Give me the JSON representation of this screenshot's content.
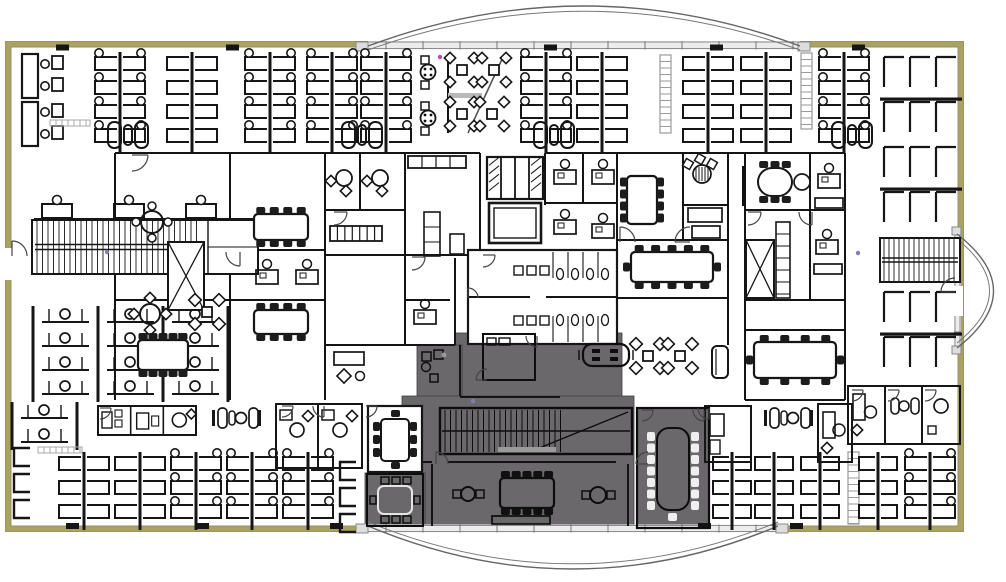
{
  "title": "Office floor plan with highlighted core zone",
  "canvas": {
    "w": 1006,
    "h": 582
  },
  "palette": {
    "floor": "#ffffff",
    "line": "#161616",
    "line_light": "#9a9a9a",
    "wall_outer": "#a9a35f",
    "wall_edge": "#6f6a40",
    "wall_inner": "#7a7446",
    "glass_fill": "#ececec",
    "glass_line": "#8d8d8d",
    "highlight": "#6b686c",
    "highlight_edge": "#403e41",
    "chair_dark": "#1c1c1c",
    "chair_light": "#efefef",
    "artifact_magenta": "#b84ab8",
    "artifact_blue": "#8080b0"
  },
  "building": {
    "x": 8,
    "y": 44,
    "w": 953,
    "h": 485
  },
  "glass": {
    "top": {
      "x": 368,
      "y": 41,
      "w": 432,
      "h": 8.5
    },
    "bottom": {
      "x": 368,
      "y": 524.5,
      "w": 410,
      "h": 8
    },
    "right": {
      "x": 954,
      "y": 234,
      "w": 7,
      "h": 114
    }
  },
  "arcs": {
    "top": {
      "x1": 368,
      "y1": 46,
      "cx": 584,
      "cy": -34,
      "x2": 800,
      "y2": 46,
      "off": 4
    },
    "bottom": {
      "x1": 368,
      "y1": 526,
      "cx": 573,
      "cy": 612,
      "x2": 778,
      "y2": 526,
      "off": -4
    },
    "right": {
      "x1": 957,
      "y1": 234,
      "cx": 1030,
      "cy": 291,
      "x2": 957,
      "y2": 348,
      "off": -5
    }
  },
  "highlights": [
    {
      "x": 455,
      "y": 333,
      "w": 167,
      "h": 65
    },
    {
      "x": 417,
      "y": 345,
      "w": 45,
      "h": 62
    },
    {
      "x": 402,
      "y": 396,
      "w": 232,
      "h": 132
    },
    {
      "x": 365,
      "y": 473,
      "w": 60,
      "h": 55
    },
    {
      "x": 637,
      "y": 408,
      "w": 72,
      "h": 120
    }
  ],
  "walls": [
    [
      115,
      153,
      115,
      400
    ],
    [
      230,
      153,
      230,
      400
    ],
    [
      325,
      153,
      325,
      400
    ],
    [
      405,
      153,
      405,
      345
    ],
    [
      480,
      153,
      480,
      255
    ],
    [
      545,
      153,
      545,
      205
    ],
    [
      583,
      153,
      583,
      203
    ],
    [
      617,
      153,
      617,
      345
    ],
    [
      683,
      153,
      683,
      240
    ],
    [
      728,
      153,
      728,
      345
    ],
    [
      745,
      153,
      745,
      400
    ],
    [
      810,
      153,
      810,
      300
    ],
    [
      845,
      153,
      845,
      400
    ],
    [
      448,
      57,
      448,
      133
    ],
    [
      455,
      258,
      455,
      345
    ],
    [
      460,
      345,
      460,
      396
    ],
    [
      432,
      464,
      432,
      526
    ],
    [
      628,
      464,
      628,
      526
    ],
    [
      360,
      153,
      360,
      210
    ],
    [
      115,
      153,
      480,
      153
    ],
    [
      545,
      153,
      845,
      153
    ],
    [
      115,
      250,
      325,
      250
    ],
    [
      405,
      255,
      480,
      255
    ],
    [
      545,
      203,
      617,
      203
    ],
    [
      683,
      205,
      728,
      205
    ],
    [
      115,
      300,
      325,
      300
    ],
    [
      325,
      210,
      405,
      210
    ],
    [
      325,
      255,
      405,
      255
    ],
    [
      405,
      300,
      450,
      300
    ],
    [
      617,
      240,
      728,
      240
    ],
    [
      617,
      298,
      728,
      298
    ],
    [
      745,
      210,
      845,
      210
    ],
    [
      745,
      300,
      845,
      300
    ],
    [
      745,
      330,
      845,
      330
    ],
    [
      745,
      400,
      845,
      400
    ],
    [
      325,
      345,
      455,
      345
    ],
    [
      402,
      462,
      432,
      462
    ],
    [
      448,
      462,
      616,
      462
    ],
    [
      460,
      397,
      560,
      397
    ],
    [
      637,
      408,
      652,
      408
    ],
    [
      692,
      408,
      709,
      408
    ]
  ],
  "diag_walls": [
    [
      503,
      57,
      468,
      133
    ]
  ],
  "door_arcs": [
    [
      132,
      155,
      16,
      0
    ],
    [
      240,
      252,
      14,
      1
    ],
    [
      334,
      212,
      13,
      0
    ],
    [
      412,
      257,
      13,
      0
    ],
    [
      620,
      242,
      15,
      3
    ],
    [
      690,
      242,
      15,
      2
    ],
    [
      748,
      212,
      13,
      0
    ],
    [
      812,
      212,
      13,
      1
    ],
    [
      100,
      408,
      11,
      0
    ],
    [
      282,
      406,
      11,
      0
    ],
    [
      324,
      406,
      11,
      1
    ],
    [
      366,
      406,
      11,
      0
    ],
    [
      436,
      464,
      12,
      3
    ],
    [
      648,
      464,
      12,
      2
    ],
    [
      709,
      408,
      11,
      1
    ],
    [
      852,
      390,
      11,
      0
    ],
    [
      888,
      390,
      11,
      0
    ],
    [
      925,
      390,
      11,
      0
    ],
    [
      642,
      410,
      11,
      0
    ],
    [
      704,
      410,
      11,
      1
    ],
    [
      487,
      380,
      11,
      2
    ],
    [
      537,
      336,
      11,
      1
    ],
    [
      12,
      256,
      15,
      3
    ],
    [
      955,
      292,
      14,
      2
    ],
    [
      483,
      255,
      12,
      0
    ],
    [
      468,
      298,
      10,
      3
    ]
  ],
  "wall_ticks": {
    "top": [
      56,
      226,
      544,
      710,
      852
    ],
    "bottom": [
      66,
      196,
      330,
      698,
      790
    ]
  },
  "wall_gaps": [
    [
      3,
      248,
      10,
      32
    ],
    [
      953,
      286,
      10,
      30
    ]
  ],
  "glass_ends": [
    [
      356,
      42,
      12,
      9
    ],
    [
      798,
      42,
      12,
      9
    ],
    [
      356,
      524,
      12,
      9
    ],
    [
      776,
      524,
      12,
      9
    ],
    [
      952,
      227,
      9,
      8
    ],
    [
      952,
      346,
      9,
      8
    ]
  ],
  "items": [
    {
      "t": "pairdesks",
      "x": 22,
      "y": 54
    },
    {
      "t": "spine",
      "x": 94,
      "y": 52,
      "rows": 4,
      "chairs": true
    },
    {
      "t": "bins",
      "x": 108,
      "y": 122
    },
    {
      "t": "spine",
      "x": 166,
      "y": 52,
      "rows": 4
    },
    {
      "t": "spine",
      "x": 244,
      "y": 52,
      "rows": 4,
      "chairs": true
    },
    {
      "t": "spine",
      "x": 306,
      "y": 52,
      "rows": 4,
      "chairs": true
    },
    {
      "t": "spine",
      "x": 360,
      "y": 52,
      "rows": 4,
      "chairs": true
    },
    {
      "t": "bins",
      "x": 342,
      "y": 122
    },
    {
      "t": "cafe",
      "x": 420,
      "y": 55
    },
    {
      "t": "spine",
      "x": 520,
      "y": 52,
      "rows": 4,
      "chairs": true
    },
    {
      "t": "bins",
      "x": 534,
      "y": 122
    },
    {
      "t": "spine",
      "x": 576,
      "y": 52,
      "rows": 4
    },
    {
      "t": "shelf",
      "x": 660,
      "y": 55,
      "h": 78
    },
    {
      "t": "spine",
      "x": 682,
      "y": 52,
      "rows": 4
    },
    {
      "t": "spine",
      "x": 740,
      "y": 52,
      "rows": 4
    },
    {
      "t": "shelf",
      "x": 801,
      "y": 53,
      "h": 76
    },
    {
      "t": "spine",
      "x": 818,
      "y": 52,
      "rows": 4,
      "chairs": true
    },
    {
      "t": "bins",
      "x": 832,
      "y": 122
    },
    {
      "t": "lgrid",
      "x": 882,
      "y": 55,
      "rows": 4
    },
    {
      "t": "stairR",
      "x": 880,
      "y": 238,
      "w": 80,
      "h": 44
    },
    {
      "t": "lgrid",
      "x": 882,
      "y": 290,
      "rows": 2
    },
    {
      "t": "room",
      "x": 848,
      "y": 386,
      "w": 37,
      "h": 58,
      "f": "desk"
    },
    {
      "t": "room",
      "x": 885,
      "y": 386,
      "w": 37,
      "h": 58,
      "f": "lounge"
    },
    {
      "t": "room",
      "x": 922,
      "y": 386,
      "w": 38,
      "h": 58,
      "f": "circle"
    },
    {
      "t": "ccol",
      "x": 14,
      "y": 448
    },
    {
      "t": "spine",
      "x": 58,
      "y": 452,
      "rows": 3
    },
    {
      "t": "spine",
      "x": 114,
      "y": 452,
      "rows": 3
    },
    {
      "t": "spine",
      "x": 170,
      "y": 452,
      "rows": 3,
      "chairs": true
    },
    {
      "t": "spine",
      "x": 226,
      "y": 452,
      "rows": 3,
      "chairs": true
    },
    {
      "t": "spine",
      "x": 282,
      "y": 452,
      "rows": 3,
      "chairs": true
    },
    {
      "t": "ccol",
      "x": 340,
      "y": 462
    },
    {
      "t": "spine",
      "x": 712,
      "y": 452,
      "rows": 3,
      "w": 40
    },
    {
      "t": "spine",
      "x": 754,
      "y": 452,
      "rows": 3,
      "w": 40
    },
    {
      "t": "spine",
      "x": 800,
      "y": 452,
      "rows": 3,
      "w": 40
    },
    {
      "t": "shelf",
      "x": 848,
      "y": 452,
      "h": 72
    },
    {
      "t": "spine",
      "x": 858,
      "y": 452,
      "rows": 3,
      "w": 40
    },
    {
      "t": "spine",
      "x": 904,
      "y": 452,
      "rows": 3,
      "chairs": true
    },
    {
      "t": "cubegrid",
      "x": 33,
      "y": 306,
      "cols": 3,
      "rows": 2
    },
    {
      "t": "cubegrid",
      "x": 33,
      "y": 354,
      "cols": 3,
      "rows": 2
    },
    {
      "t": "cubegrid",
      "x": 12,
      "y": 402,
      "cols": 1,
      "rows": 2
    },
    {
      "t": "lightstrip",
      "x": 50,
      "y": 120,
      "w": 40
    },
    {
      "t": "lightstrip",
      "x": 38,
      "y": 447,
      "w": 44
    },
    {
      "t": "deskrow",
      "x": 34,
      "y": 196
    },
    {
      "t": "stairL",
      "x": 32,
      "y": 220,
      "w": 226,
      "h": 54
    },
    {
      "t": "roundtable",
      "x": 152,
      "y": 222,
      "r": 11,
      "st": "circle"
    },
    {
      "t": "xcab",
      "x": 168,
      "y": 242,
      "w": 36,
      "h": 68
    },
    {
      "t": "roundtable",
      "x": 150,
      "y": 314,
      "r": 10,
      "st": "diamond"
    },
    {
      "t": "diamondset",
      "x": 207,
      "y": 312
    },
    {
      "t": "conftable",
      "x": 138,
      "y": 340,
      "w": 50,
      "h": 30,
      "top": 5,
      "bot": 5
    },
    {
      "t": "conftable",
      "x": 254,
      "y": 214,
      "w": 54,
      "h": 26,
      "top": 4,
      "bot": 4
    },
    {
      "t": "deskchair",
      "x": 256,
      "y": 270
    },
    {
      "t": "deskchair",
      "x": 296,
      "y": 270
    },
    {
      "t": "conftable",
      "x": 254,
      "y": 310,
      "w": 54,
      "h": 24,
      "top": 4,
      "bot": 4
    },
    {
      "t": "nook",
      "x": 344,
      "y": 178
    },
    {
      "t": "nook",
      "x": 380,
      "y": 178
    },
    {
      "t": "lockers",
      "x": 330,
      "y": 226,
      "w": 52,
      "h": 15,
      "n": 7
    },
    {
      "t": "deskitems",
      "x": 334,
      "y": 352
    },
    {
      "t": "pantry",
      "x": 408,
      "y": 156
    },
    {
      "t": "elevbank",
      "x": 487,
      "y": 157,
      "w": 56,
      "h": 42
    },
    {
      "t": "servelev",
      "x": 489,
      "y": 203,
      "w": 52,
      "h": 40
    },
    {
      "t": "restrooms",
      "x": 468,
      "y": 250,
      "w": 149,
      "h": 94
    },
    {
      "t": "deskchair",
      "x": 554,
      "y": 170
    },
    {
      "t": "deskchair",
      "x": 592,
      "y": 170
    },
    {
      "t": "deskchair",
      "x": 554,
      "y": 220
    },
    {
      "t": "deskchair",
      "x": 592,
      "y": 224
    },
    {
      "t": "deskchair",
      "x": 414,
      "y": 310
    },
    {
      "t": "conftable",
      "x": 627,
      "y": 176,
      "w": 30,
      "h": 48,
      "left": 4,
      "right": 4
    },
    {
      "t": "loungenook",
      "x": 702,
      "y": 174
    },
    {
      "t": "credenza",
      "x": 688,
      "y": 208,
      "w": 34,
      "h": 14
    },
    {
      "t": "credenza",
      "x": 692,
      "y": 226,
      "w": 28,
      "h": 12
    },
    {
      "t": "conftable",
      "x": 631,
      "y": 252,
      "w": 82,
      "h": 30,
      "top": 5,
      "bot": 5,
      "ends": true
    },
    {
      "t": "vbar",
      "x": 742,
      "y": 166,
      "h": 40
    },
    {
      "t": "ovaltable",
      "x": 758,
      "y": 168,
      "w": 34,
      "h": 28
    },
    {
      "t": "deskchair",
      "x": 818,
      "y": 174
    },
    {
      "t": "credenza",
      "x": 815,
      "y": 198,
      "w": 28,
      "h": 10
    },
    {
      "t": "xcab",
      "x": 746,
      "y": 240,
      "w": 28,
      "h": 58
    },
    {
      "t": "cabcol",
      "x": 776,
      "y": 222,
      "w": 14,
      "h": 76
    },
    {
      "t": "deskchair",
      "x": 816,
      "y": 240
    },
    {
      "t": "credenza",
      "x": 814,
      "y": 264,
      "w": 28,
      "h": 10
    },
    {
      "t": "conftable",
      "x": 754,
      "y": 342,
      "w": 82,
      "h": 36,
      "top": 4,
      "bot": 4,
      "ends": true
    },
    {
      "t": "diamondset",
      "x": 648,
      "y": 356
    },
    {
      "t": "diamondset",
      "x": 680,
      "y": 356
    },
    {
      "t": "sofa",
      "x": 712,
      "y": 346,
      "w": 16,
      "h": 32
    },
    {
      "t": "phoneblock",
      "x": 98,
      "y": 406,
      "w": 98,
      "h": 29
    },
    {
      "t": "loungerow",
      "x": 212,
      "y": 410
    },
    {
      "t": "room",
      "x": 276,
      "y": 404,
      "w": 42,
      "h": 64,
      "f": "office"
    },
    {
      "t": "room",
      "x": 318,
      "y": 404,
      "w": 44,
      "h": 64,
      "f": "office"
    },
    {
      "t": "room",
      "x": 705,
      "y": 406,
      "w": 46,
      "h": 56,
      "f": "office2"
    },
    {
      "t": "loungerow",
      "x": 764,
      "y": 410
    },
    {
      "t": "room",
      "x": 818,
      "y": 404,
      "w": 34,
      "h": 58,
      "f": "desk"
    },
    {
      "t": "room",
      "x": 483,
      "y": 334,
      "w": 52,
      "h": 46,
      "f": "deskS",
      "dark": true
    },
    {
      "t": "sofatable",
      "x": 583,
      "y": 344
    },
    {
      "t": "wingdesks",
      "x": 420,
      "y": 350
    },
    {
      "t": "stairMain",
      "x": 440,
      "y": 408,
      "w": 192,
      "h": 46
    },
    {
      "t": "whitemeeting",
      "x": 368,
      "y": 406,
      "w": 54,
      "h": 66
    },
    {
      "t": "darkmeeting",
      "x": 367,
      "y": 474,
      "w": 56,
      "h": 52
    },
    {
      "t": "conftable",
      "x": 500,
      "y": 478,
      "w": 54,
      "h": 30,
      "top": 5,
      "bot": 5,
      "dark": true
    },
    {
      "t": "credenza",
      "x": 492,
      "y": 516,
      "w": 58,
      "h": 8,
      "dark": true
    },
    {
      "t": "roundtable",
      "x": 468,
      "y": 494,
      "r": 7,
      "st": "sq",
      "dark": true
    },
    {
      "t": "roundtable",
      "x": 598,
      "y": 495,
      "r": 8,
      "st": "sq",
      "dark": true
    },
    {
      "t": "confroomdark",
      "x": 637,
      "y": 408,
      "w": 72,
      "h": 120
    },
    {
      "t": "dot",
      "x": 440,
      "y": 57,
      "c": "#b84ab8"
    },
    {
      "t": "dot",
      "x": 107,
      "y": 252,
      "c": "#8080b0"
    },
    {
      "t": "dot",
      "x": 473,
      "y": 401,
      "c": "#8080b0"
    },
    {
      "t": "dot",
      "x": 858,
      "y": 253,
      "c": "#8080b0"
    }
  ]
}
